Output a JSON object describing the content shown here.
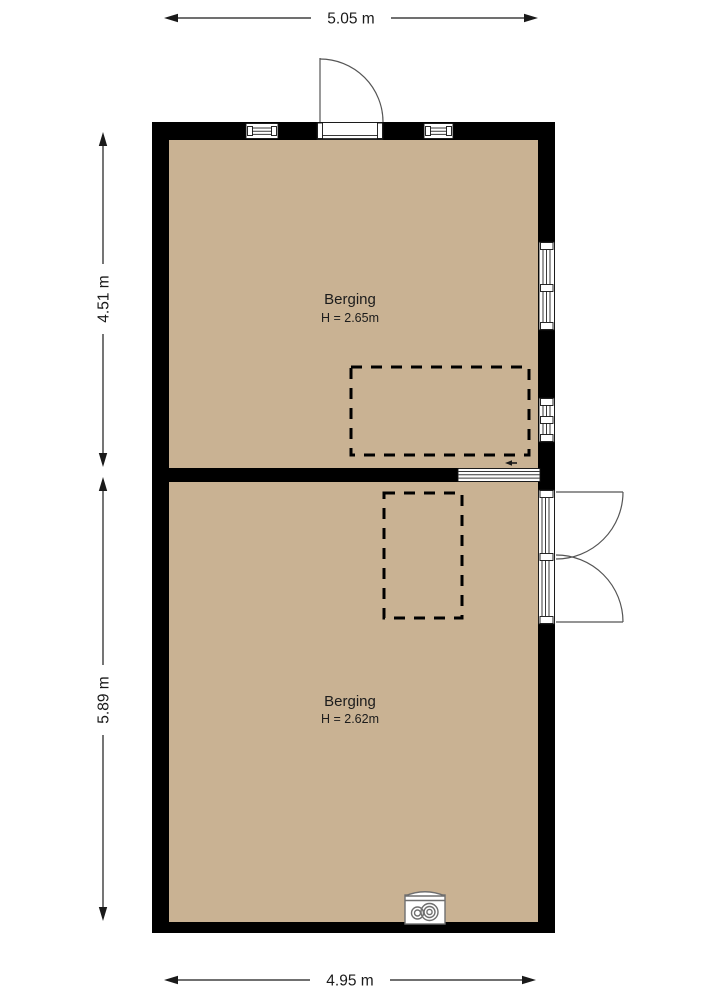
{
  "plan": {
    "colors": {
      "floor": "#c9b293",
      "wall": "#000000",
      "line": "#1a1a1a"
    },
    "dimensions": {
      "top": "5.05 m",
      "bottom": "4.95 m",
      "left_upper": "4.51 m",
      "left_lower": "5.89 m"
    },
    "rooms": {
      "upper": {
        "name": "Berging",
        "height": "H = 2.65m"
      },
      "lower": {
        "name": "Berging",
        "height": "H = 2.62m"
      }
    }
  }
}
